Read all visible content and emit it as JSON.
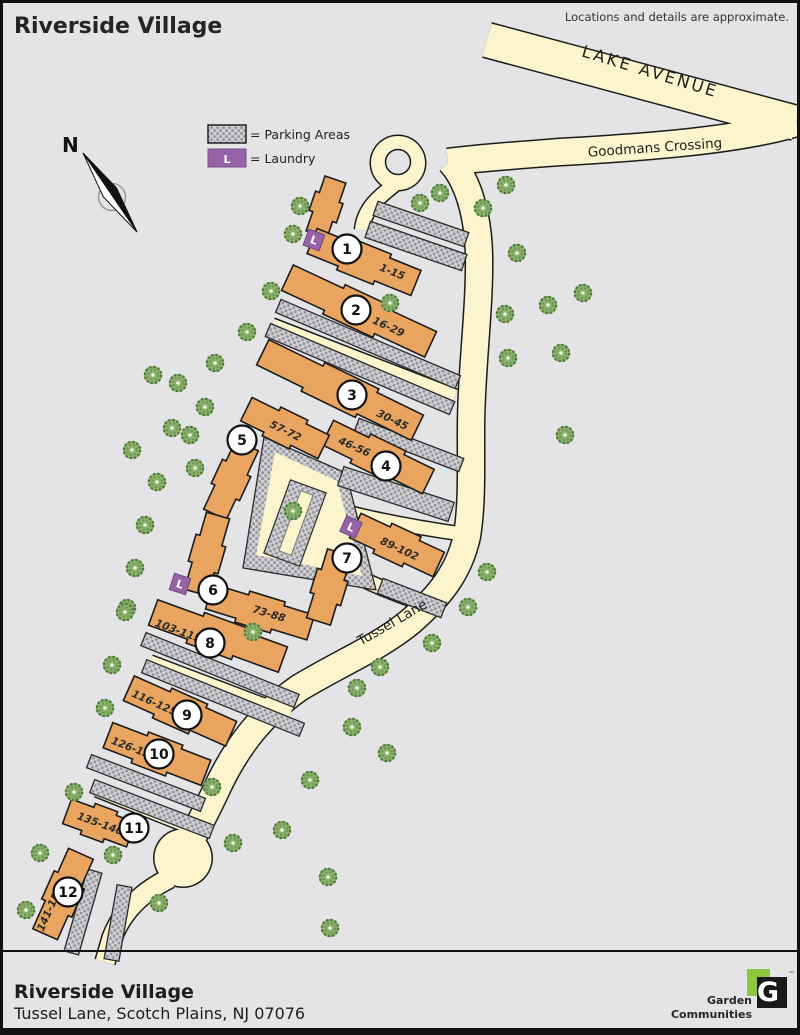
{
  "header": {
    "title": "Riverside Village",
    "disclaimer": "Locations and details are approximate."
  },
  "legend": {
    "parking_label": "= Parking Areas",
    "laundry_label": "= Laundry",
    "laundry_letter": "L"
  },
  "compass": {
    "north_label": "N"
  },
  "roads": [
    {
      "name": "LAKE AVENUE"
    },
    {
      "name": "Goodmans Crossing"
    },
    {
      "name": "Tussel Lane"
    }
  ],
  "map": {
    "buildings": [
      {
        "number": "1",
        "units": "1-15",
        "laundry": true
      },
      {
        "number": "2",
        "units": "16-29",
        "laundry": false
      },
      {
        "number": "3",
        "units": "30-45",
        "laundry": false
      },
      {
        "number": "4",
        "units": "46-56",
        "laundry": false
      },
      {
        "number": "5",
        "units": "57-72",
        "laundry": false
      },
      {
        "number": "6",
        "units": "73-88",
        "laundry": true
      },
      {
        "number": "7",
        "units": "89-102",
        "laundry": true
      },
      {
        "number": "8",
        "units": "103-115",
        "laundry": false
      },
      {
        "number": "9",
        "units": "116-125",
        "laundry": false
      },
      {
        "number": "10",
        "units": "126-134",
        "laundry": false
      },
      {
        "number": "11",
        "units": "135-140",
        "laundry": false
      },
      {
        "number": "12",
        "units": "141-150",
        "laundry": false
      }
    ]
  },
  "footer": {
    "title": "Riverside Village",
    "address": "Tussel Lane, Scotch Plains, NJ 07076",
    "logo": {
      "letter": "G",
      "line1": "Garden",
      "line2": "Communities",
      "tm": "™"
    }
  },
  "colors": {
    "background": "#E4E4E7",
    "road": "#FBF4CD",
    "road_casing": "#1C1C1C",
    "building": "#E9A55F",
    "parking_base": "#CFCFD3",
    "parking_dot": "#8C8C91",
    "laundry_purple": "#9663A8",
    "tree_green": "#8AB06A",
    "logo_green": "#8DC63F"
  }
}
